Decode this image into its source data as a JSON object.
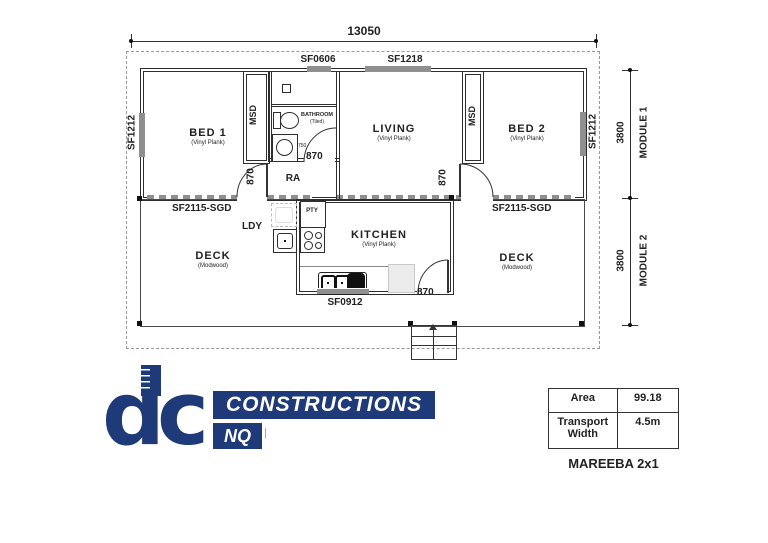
{
  "colors": {
    "navy": "#1e3a78",
    "wall": "#2e2e2e",
    "window_fill": "#8f8f8f"
  },
  "plan": {
    "width_dim": "13050",
    "modules": [
      {
        "name": "MODULE 1",
        "dim": "3800"
      },
      {
        "name": "MODULE 2",
        "dim": "3800"
      }
    ],
    "rooms": {
      "bed1": {
        "name": "BED 1",
        "finish": "(Vinyl Plank)"
      },
      "bed2": {
        "name": "BED 2",
        "finish": "(Vinyl Plank)"
      },
      "living": {
        "name": "LIVING",
        "finish": "(Vinyl Plank)"
      },
      "kitchen": {
        "name": "KITCHEN",
        "finish": "(Vinyl Plank)"
      },
      "bathroom": {
        "name": "BATHROOM",
        "finish": "(Tiled)"
      },
      "deck": {
        "name": "DECK",
        "finish": "(Modwood)"
      }
    },
    "tags": {
      "ldy": "LDY",
      "pty": "PTY",
      "ra": "RA",
      "robe": "MSD",
      "door_width": "870",
      "vanity_width": "750"
    },
    "openings": {
      "side_window": "SF1212",
      "bathroom_window": "SF0606",
      "living_window": "SF1218",
      "kitchen_window": "SF0912",
      "sliding_door": "SF2115-SGD"
    }
  },
  "logo": {
    "monogram": "dc",
    "line1": "CONSTRUCTIONS",
    "line2": "NQ"
  },
  "spec_table": {
    "rows": [
      {
        "label": "Area",
        "value": "99.18"
      },
      {
        "label": "Transport Width",
        "value": "4.5m"
      }
    ]
  },
  "plan_title": "MAREEBA 2x1"
}
